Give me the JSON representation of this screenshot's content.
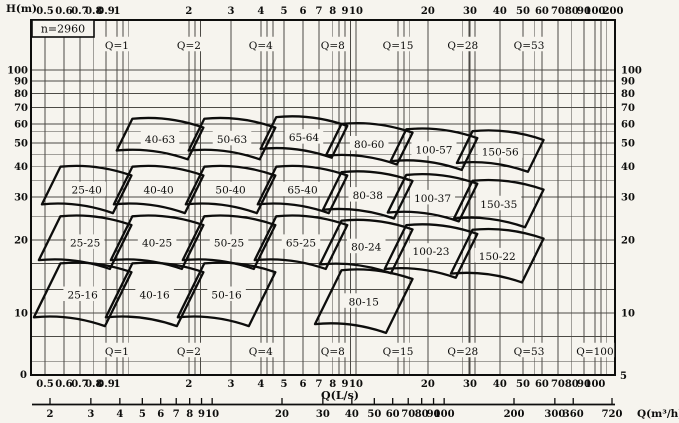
{
  "chart_data": {
    "type": "area",
    "title": "",
    "speed_label": "n=2960",
    "x_axis": {
      "label": "Q(L/s)",
      "scale": "log",
      "range": [
        0.44,
        121
      ],
      "major_ticks": [
        0.5,
        0.6,
        0.7,
        0.8,
        0.9,
        1,
        2,
        3,
        4,
        5,
        6,
        7,
        8,
        9,
        10,
        20,
        30,
        40,
        50,
        60,
        70,
        80,
        90,
        100
      ],
      "top_edge_tick_label": "200",
      "minor_gridlines": [
        1.06,
        1.12,
        2.12,
        2.24,
        4.24,
        4.5,
        8.5,
        9.5,
        15,
        15.9,
        16.8,
        28,
        29.7,
        31.5,
        56,
        106,
        112
      ]
    },
    "y_axis": {
      "label": "H(m)",
      "scale": "log",
      "range": [
        5.6,
        160
      ],
      "major_ticks": [
        10,
        20,
        30,
        40,
        50,
        60,
        70,
        80,
        90,
        100
      ],
      "minor_gridlines": [
        6.3,
        8,
        12.5,
        16,
        25,
        35,
        45,
        56
      ],
      "left_bottom_label": "0",
      "right_bottom_label": "5"
    },
    "x_axis_secondary": {
      "label": "Q(m³/h)",
      "ticks": [
        2,
        3,
        4,
        5,
        6,
        7,
        8,
        9,
        10,
        20,
        30,
        40,
        50,
        60,
        70,
        80,
        90,
        100,
        200,
        300,
        360,
        720
      ]
    },
    "flow_lines": [
      {
        "label": "Q=1",
        "value": 1,
        "show_top": true,
        "show_bottom": true
      },
      {
        "label": "Q=2",
        "value": 2,
        "show_top": true,
        "show_bottom": true
      },
      {
        "label": "Q=4",
        "value": 4,
        "show_top": true,
        "show_bottom": true
      },
      {
        "label": "Q=8",
        "value": 8,
        "show_top": true,
        "show_bottom": true
      },
      {
        "label": "Q=15",
        "value": 15,
        "show_top": true,
        "show_bottom": true
      },
      {
        "label": "Q=28",
        "value": 28,
        "show_top": true,
        "show_bottom": true
      },
      {
        "label": "Q=53",
        "value": 53,
        "show_top": true,
        "show_bottom": true
      },
      {
        "label": "Q=100",
        "value": 100,
        "show_top": false,
        "show_bottom": true
      }
    ],
    "regions": [
      {
        "label": "40-63",
        "q": 2,
        "head": 63,
        "row": 0
      },
      {
        "label": "50-63",
        "q": 4,
        "head": 63,
        "row": 0
      },
      {
        "label": "65-64",
        "q": 8,
        "head": 64,
        "row": 0
      },
      {
        "label": "80-60",
        "q": 15,
        "head": 60,
        "row": 0
      },
      {
        "label": "100-57",
        "q": 28,
        "head": 57,
        "row": 0
      },
      {
        "label": "150-56",
        "q": 53,
        "head": 56,
        "row": 0
      },
      {
        "label": "25-40",
        "q": 1,
        "head": 40,
        "row": 1
      },
      {
        "label": "40-40",
        "q": 2,
        "head": 40,
        "row": 1
      },
      {
        "label": "50-40",
        "q": 4,
        "head": 40,
        "row": 1
      },
      {
        "label": "65-40",
        "q": 8,
        "head": 40,
        "row": 1
      },
      {
        "label": "80-38",
        "q": 15,
        "head": 38,
        "row": 1
      },
      {
        "label": "100-37",
        "q": 28,
        "head": 37,
        "row": 1
      },
      {
        "label": "150-35",
        "q": 53,
        "head": 35,
        "row": 1
      },
      {
        "label": "25-25",
        "q": 1,
        "head": 25,
        "row": 2
      },
      {
        "label": "40-25",
        "q": 2,
        "head": 25,
        "row": 2
      },
      {
        "label": "50-25",
        "q": 4,
        "head": 25,
        "row": 2
      },
      {
        "label": "65-25",
        "q": 8,
        "head": 25,
        "row": 2
      },
      {
        "label": "80-24",
        "q": 15,
        "head": 24,
        "row": 2
      },
      {
        "label": "100-23",
        "q": 28,
        "head": 23,
        "row": 2
      },
      {
        "label": "150-22",
        "q": 53,
        "head": 22,
        "row": 2
      },
      {
        "label": "25-16",
        "q": 1,
        "head": 16,
        "row": 3
      },
      {
        "label": "40-16",
        "q": 2,
        "head": 16,
        "row": 3
      },
      {
        "label": "50-16",
        "q": 4,
        "head": 16,
        "row": 3
      },
      {
        "label": "80-15",
        "q": 15,
        "head": 15,
        "row": 3
      }
    ],
    "colors": {
      "background": "#f6f4ee",
      "grid": "#4c4a45",
      "ink": "#0d0d0c"
    }
  }
}
